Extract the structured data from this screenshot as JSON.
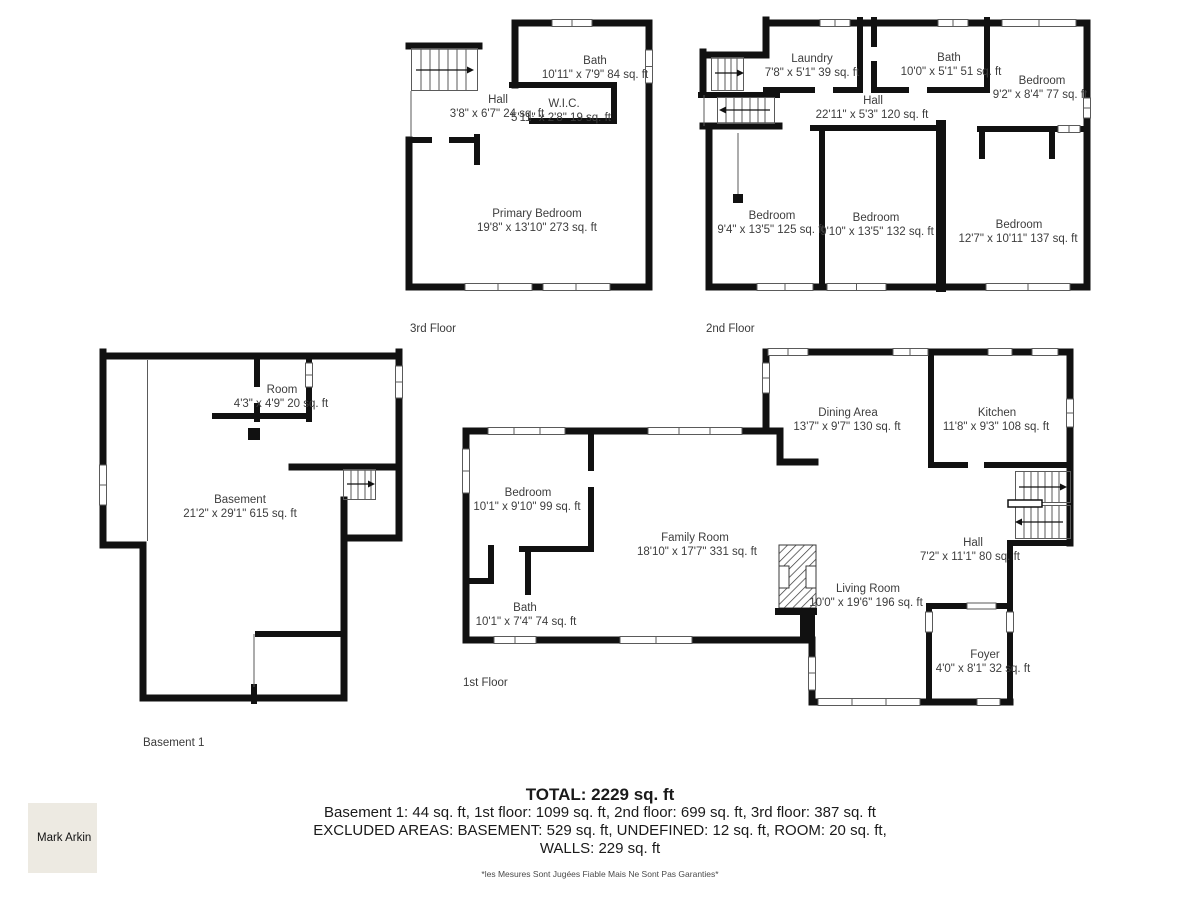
{
  "floors": {
    "third": {
      "label": "3rd Floor",
      "rooms": {
        "bath": {
          "name": "Bath",
          "dims": "10'11\" x 7'9\" 84 sq. ft"
        },
        "hall": {
          "name": "Hall",
          "dims": "3'8\" x 6'7\" 24 sq. ft"
        },
        "wic": {
          "name": "W.I.C.",
          "dims": "5'11\" x 2'8\" 19 sq. ft"
        },
        "primary": {
          "name": "Primary Bedroom",
          "dims": "19'8\" x 13'10\" 273 sq. ft"
        }
      }
    },
    "second": {
      "label": "2nd Floor",
      "rooms": {
        "laundry": {
          "name": "Laundry",
          "dims": "7'8\" x 5'1\" 39 sq. ft"
        },
        "bath": {
          "name": "Bath",
          "dims": "10'0\" x 5'1\" 51 sq. ft"
        },
        "bedroom_tr": {
          "name": "Bedroom",
          "dims": "9'2\" x 8'4\" 77 sq. ft"
        },
        "hall": {
          "name": "Hall",
          "dims": "22'11\" x 5'3\" 120 sq. ft"
        },
        "bedroom1": {
          "name": "Bedroom",
          "dims": "9'4\" x 13'5\" 125 sq. ft"
        },
        "bedroom2": {
          "name": "Bedroom",
          "dims": "9'10\" x 13'5\" 132 sq. ft"
        },
        "bedroom3": {
          "name": "Bedroom",
          "dims": "12'7\" x 10'11\" 137 sq. ft"
        }
      }
    },
    "first": {
      "label": "1st Floor",
      "rooms": {
        "bedroom": {
          "name": "Bedroom",
          "dims": "10'1\" x 9'10\" 99 sq. ft"
        },
        "bath": {
          "name": "Bath",
          "dims": "10'1\" x 7'4\" 74 sq. ft"
        },
        "family": {
          "name": "Family Room",
          "dims": "18'10\" x 17'7\" 331 sq. ft"
        },
        "dining": {
          "name": "Dining Area",
          "dims": "13'7\" x 9'7\" 130 sq. ft"
        },
        "kitchen": {
          "name": "Kitchen",
          "dims": "11'8\" x 9'3\" 108 sq. ft"
        },
        "hall": {
          "name": "Hall",
          "dims": "7'2\" x 11'1\" 80 sq. ft"
        },
        "living": {
          "name": "Living Room",
          "dims": "10'0\" x 19'6\" 196 sq. ft"
        },
        "foyer": {
          "name": "Foyer",
          "dims": "4'0\" x 8'1\" 32 sq. ft"
        }
      }
    },
    "basement": {
      "label": "Basement 1",
      "rooms": {
        "room": {
          "name": "Room",
          "dims": "4'3\" x 4'9\" 20 sq. ft"
        },
        "basement": {
          "name": "Basement",
          "dims": "21'2\" x 29'1\" 615 sq. ft"
        }
      }
    }
  },
  "summary": {
    "total": "TOTAL: 2229 sq. ft",
    "line1": "Basement 1: 44 sq. ft, 1st floor: 1099 sq. ft, 2nd floor: 699 sq. ft, 3rd floor: 387 sq. ft",
    "line2": "EXCLUDED AREAS: BASEMENT: 529 sq. ft, UNDEFINED: 12 sq. ft, ROOM: 20 sq. ft,",
    "line3": "WALLS: 229 sq. ft"
  },
  "watermark": "Mark Arkin",
  "disclaimer": "*les Mesures Sont Jugées Fiable Mais Ne Sont Pas Garanties*",
  "colors": {
    "wall": "#111111",
    "text": "#3d3d3d",
    "watermark_bg": "#edeae2"
  }
}
